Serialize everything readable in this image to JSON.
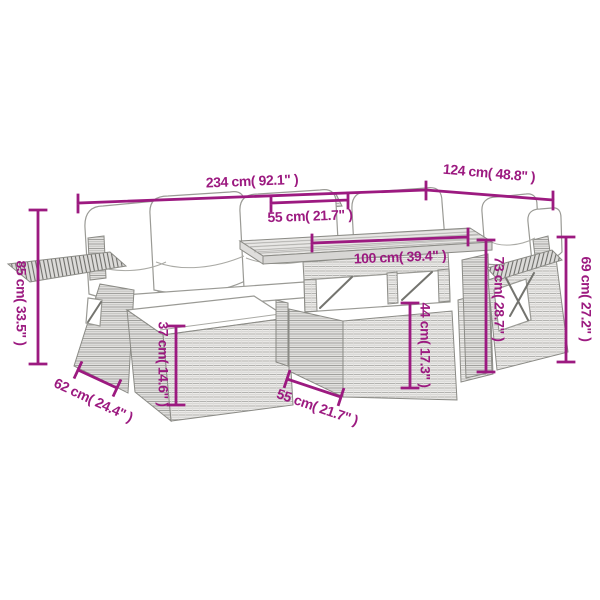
{
  "page": {
    "background": "#ffffff"
  },
  "diagram": {
    "accent_color": "#9C1A80",
    "line_art_color": "#8B8B86",
    "labels": {
      "overall_width": "234 cm( 92.1\" )",
      "overall_depth": "124 cm( 48.8\" )",
      "tabletop_depth": "55 cm( 21.7\" )",
      "tabletop_length": "100 cm( 39.4\" )",
      "overall_height": "85 cm( 33.5\" )",
      "footstool_height": "37 cm( 14.6\" )",
      "table_base_height": "44 cm( 17.3\" )",
      "table_height": "73 cm( 28.7\" )",
      "backrest_height": "69 cm( 27.2\" )",
      "footstool_depth": "62 cm( 24.4\" )",
      "table_base_depth": "55 cm( 21.7\" )"
    }
  }
}
